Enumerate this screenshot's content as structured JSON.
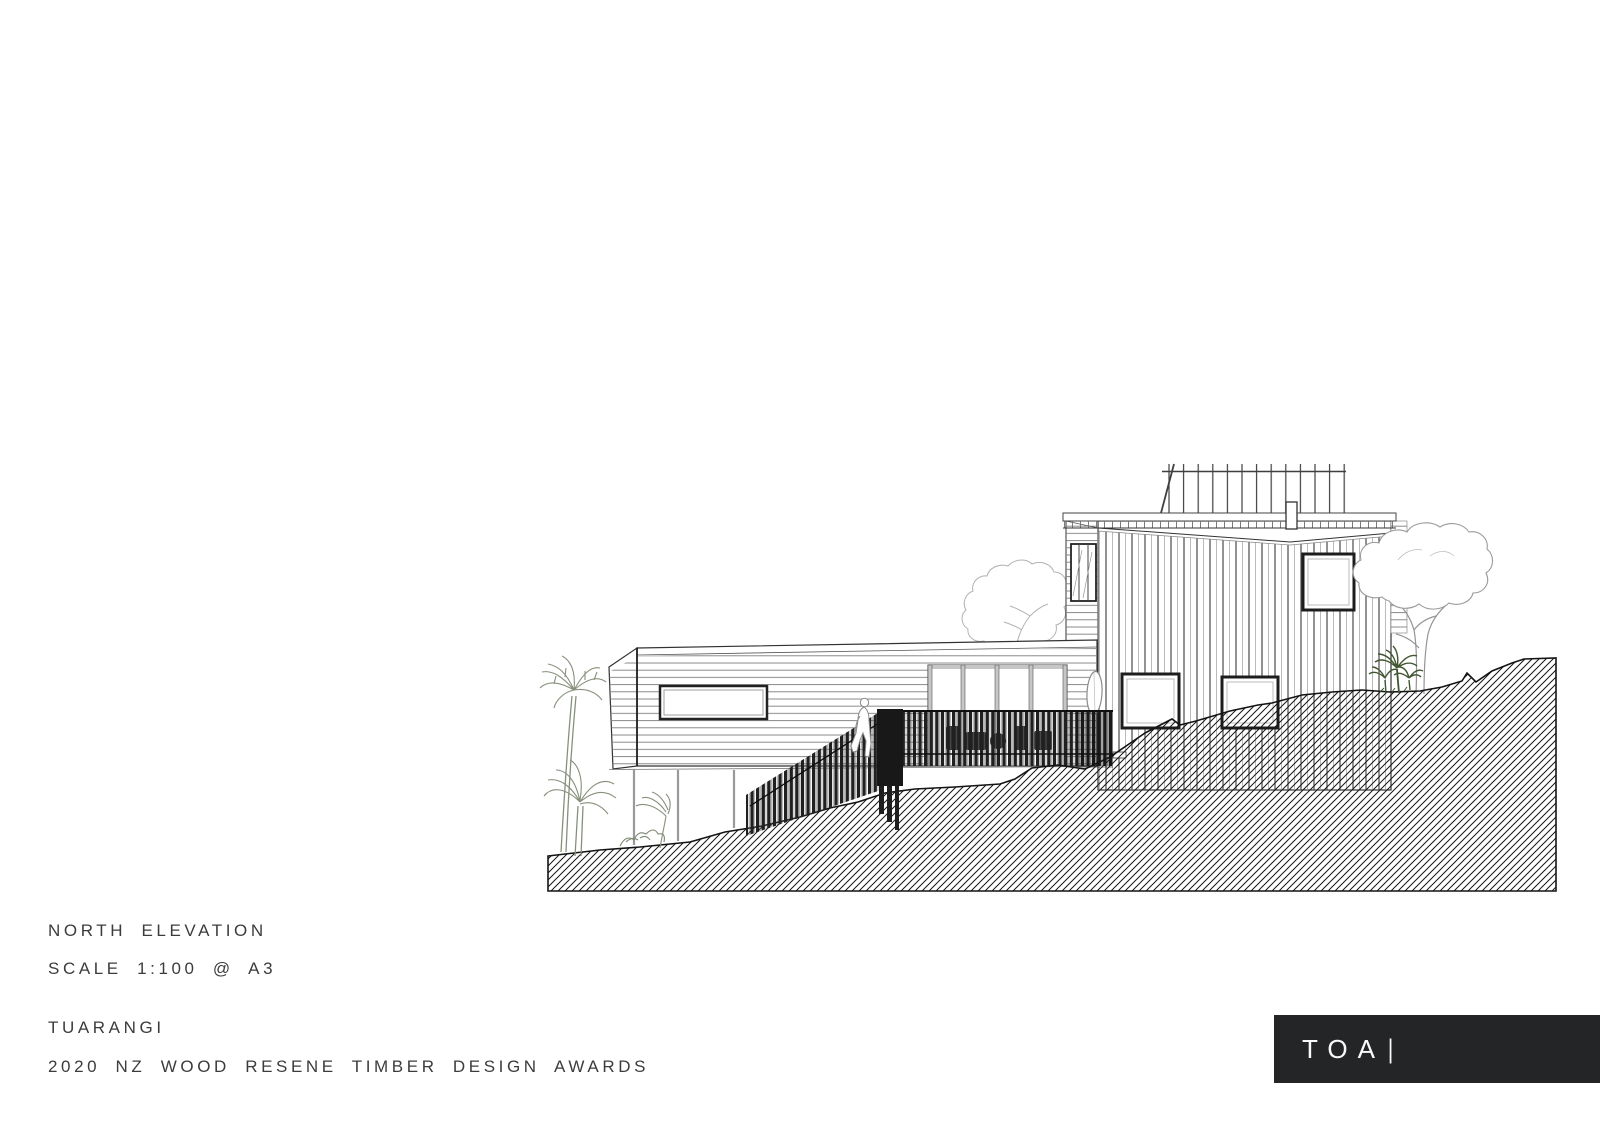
{
  "page": {
    "background": "#ffffff"
  },
  "title_block": {
    "drawing_title": "NORTH ELEVATION",
    "scale_note": "SCALE 1:100 @ A3",
    "project_name": "TUARANGI",
    "award_line": "2020 NZ WOOD RESENE TIMBER DESIGN AWARDS",
    "text_color": "#3c3c3c"
  },
  "logo": {
    "text": "TOA",
    "divider": "|",
    "background": "#232527",
    "color": "#fafafa"
  },
  "drawing": {
    "type": "architectural-elevation-line-drawing",
    "ink_color": "#161616",
    "cladding_line_color": "#7d7d7d",
    "slat_color": "#202020",
    "tree_grey": "#a8a8a8",
    "plant_green_grey": "#87907c",
    "palm_dark_green": "#41552f",
    "elements": [
      "hatched-hillside-terrain",
      "left-wing-horizontal-cladding",
      "wing-window",
      "four-panel-glazed-doors",
      "support-posts",
      "tower-vertical-cladding",
      "roof-deck-balustrade",
      "flue",
      "tower-square-windows",
      "louvre-window",
      "surfboard",
      "deck-slat-screen",
      "stair-slat-balustrade",
      "scale-figure",
      "palm-trees",
      "banana-plant",
      "shrubs",
      "middle-tree",
      "right-tree",
      "cabbage-palm"
    ]
  }
}
